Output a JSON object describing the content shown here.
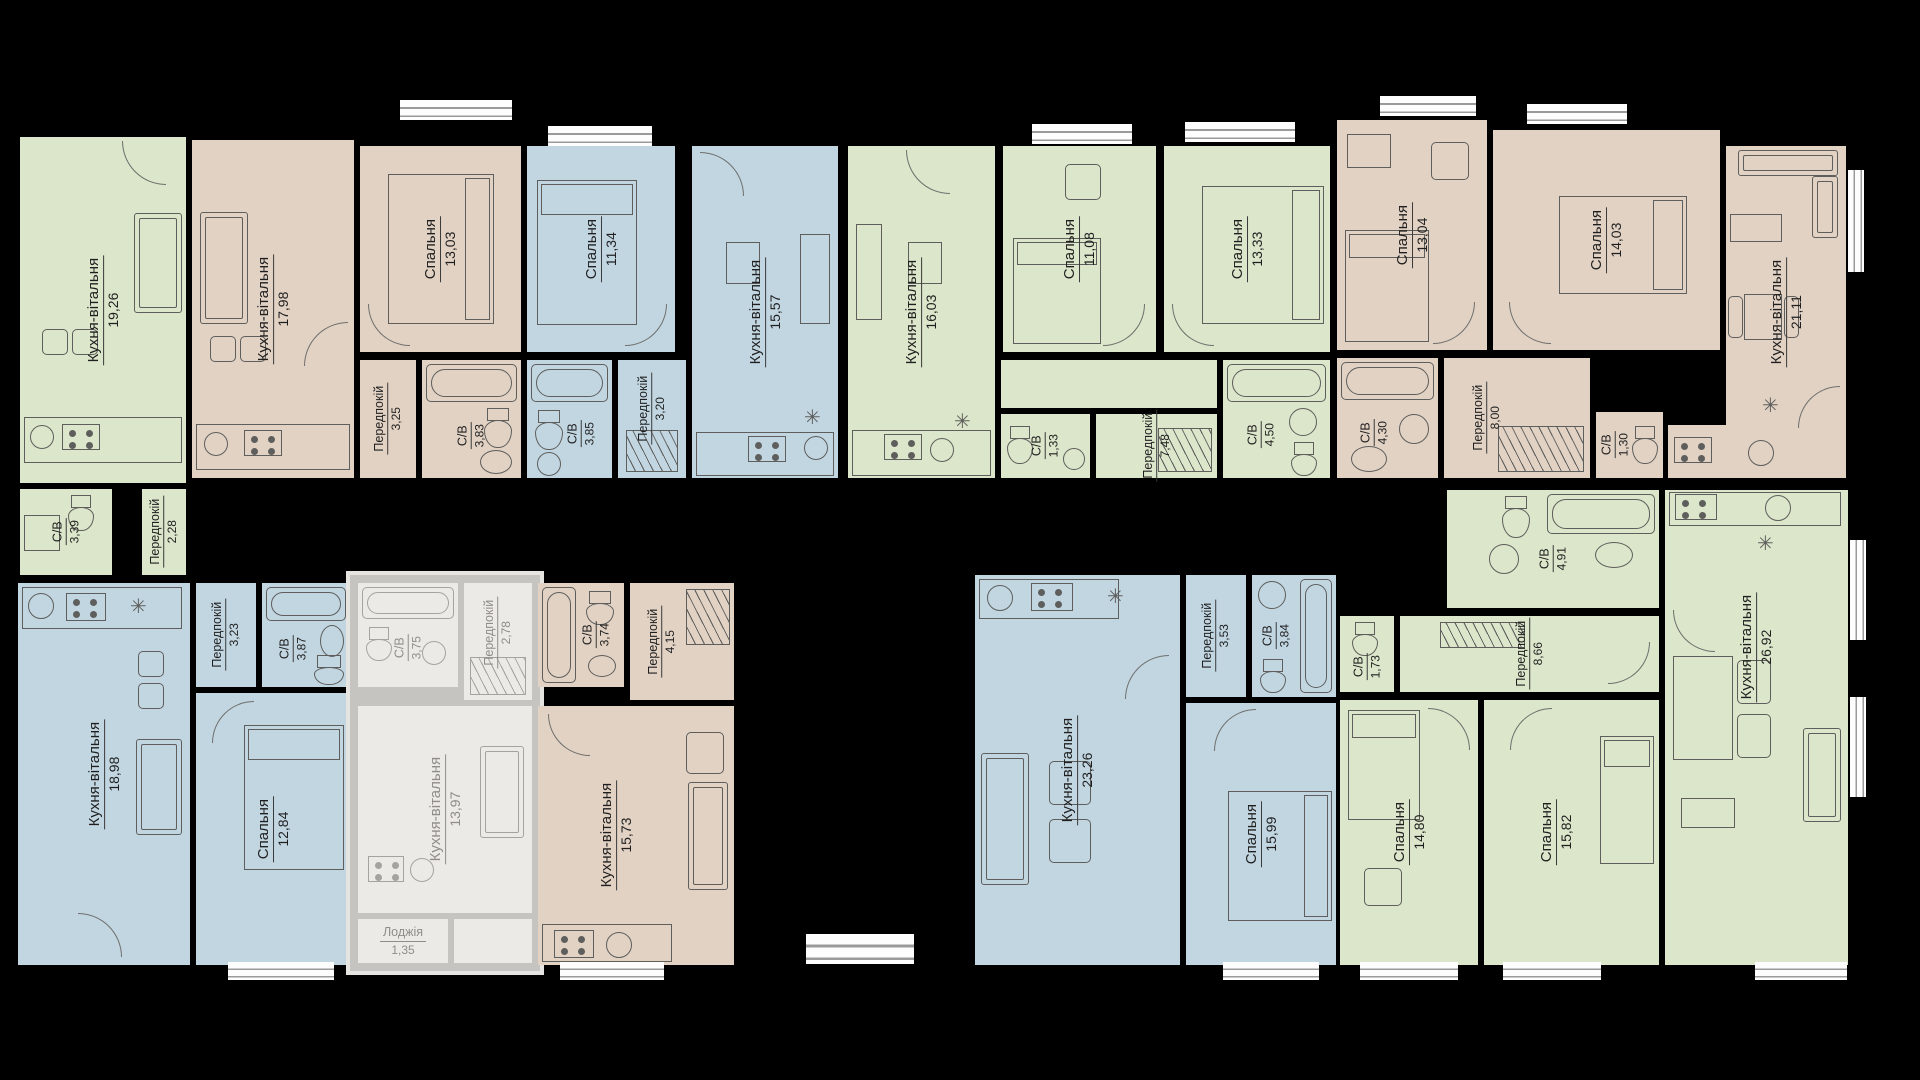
{
  "floorplan": {
    "language": "uk",
    "room_type_names": {
      "kitchen_living": "Кухня-вітальня",
      "bedroom": "Спальня",
      "hallway": "Передпокій",
      "bathroom": "С/В",
      "loggia": "Лоджія"
    }
  },
  "icons": {
    "fridge": "✳"
  },
  "colors": {
    "background": "#000000",
    "wall": "#000000",
    "apartment_green": "#dbe6ca",
    "apartment_tan": "#e2d2c4",
    "apartment_blue": "#c2d6e2",
    "apartment_faded": "#eceae6",
    "window": "#fdfdfd",
    "furniture_line": "#5e5e5c",
    "label_text": "#1f1f1f"
  },
  "apartments": [
    {
      "id": "apt-1",
      "color": "green",
      "rooms": [
        {
          "name": "Кухня-вітальня",
          "area": "19,26"
        },
        {
          "name": "С/В",
          "area": "3,39"
        },
        {
          "name": "Передпокій",
          "area": "2,28"
        }
      ]
    },
    {
      "id": "apt-2",
      "color": "tan",
      "rooms": [
        {
          "name": "Кухня-вітальня",
          "area": "17,98"
        },
        {
          "name": "Спальня",
          "area": "13,03"
        },
        {
          "name": "Передпокій",
          "area": "3,25"
        },
        {
          "name": "С/В",
          "area": "3,83"
        }
      ]
    },
    {
      "id": "apt-3",
      "color": "blue",
      "rooms": [
        {
          "name": "Спальня",
          "area": "11,34"
        },
        {
          "name": "С/В",
          "area": "3,85"
        },
        {
          "name": "Передпокій",
          "area": "3,20"
        },
        {
          "name": "Кухня-вітальня",
          "area": "15,57"
        }
      ]
    },
    {
      "id": "apt-4",
      "color": "green",
      "rooms": [
        {
          "name": "Кухня-вітальня",
          "area": "16,03"
        },
        {
          "name": "Спальня",
          "area": "11,08"
        },
        {
          "name": "Спальня",
          "area": "13,33"
        },
        {
          "name": "Передпокій",
          "area": "7,48"
        },
        {
          "name": "С/В",
          "area": "1,33"
        },
        {
          "name": "С/В",
          "area": "4,50"
        }
      ]
    },
    {
      "id": "apt-5",
      "color": "tan",
      "rooms": [
        {
          "name": "Спальня",
          "area": "13,04"
        },
        {
          "name": "Спальня",
          "area": "14,03"
        },
        {
          "name": "Кухня-вітальня",
          "area": "21,11"
        },
        {
          "name": "С/В",
          "area": "4,30"
        },
        {
          "name": "Передпокій",
          "area": "8,00"
        },
        {
          "name": "С/В",
          "area": "1,30"
        }
      ]
    },
    {
      "id": "apt-6",
      "color": "blue",
      "rooms": [
        {
          "name": "Кухня-вітальня",
          "area": "18,98"
        },
        {
          "name": "Передпокій",
          "area": "3,23"
        },
        {
          "name": "С/В",
          "area": "3,87"
        },
        {
          "name": "Спальня",
          "area": "12,84"
        }
      ]
    },
    {
      "id": "apt-7",
      "color": "faded-gray",
      "faded": true,
      "rooms": [
        {
          "name": "С/В",
          "area": "3,75"
        },
        {
          "name": "Передпокій",
          "area": "2,78"
        },
        {
          "name": "Кухня-вітальня",
          "area": "13,97"
        },
        {
          "name": "Лоджія",
          "area": "1,35"
        }
      ]
    },
    {
      "id": "apt-8",
      "color": "tan",
      "rooms": [
        {
          "name": "С/В",
          "area": "3,74"
        },
        {
          "name": "Передпокій",
          "area": "4,15"
        },
        {
          "name": "Кухня-вітальня",
          "area": "15,73"
        }
      ]
    },
    {
      "id": "apt-9",
      "color": "blue",
      "rooms": [
        {
          "name": "Кухня-вітальня",
          "area": "23,26"
        },
        {
          "name": "Передпокій",
          "area": "3,53"
        },
        {
          "name": "С/В",
          "area": "3,84"
        },
        {
          "name": "Спальня",
          "area": "15,99"
        }
      ]
    },
    {
      "id": "apt-10",
      "color": "green",
      "rooms": [
        {
          "name": "С/В",
          "area": "4,91"
        },
        {
          "name": "С/В",
          "area": "1,73"
        },
        {
          "name": "Передпокій",
          "area": "8,66"
        },
        {
          "name": "Спальня",
          "area": "14,80"
        },
        {
          "name": "Спальня",
          "area": "15,82"
        },
        {
          "name": "Кухня-вітальня",
          "area": "26,92"
        }
      ]
    }
  ]
}
